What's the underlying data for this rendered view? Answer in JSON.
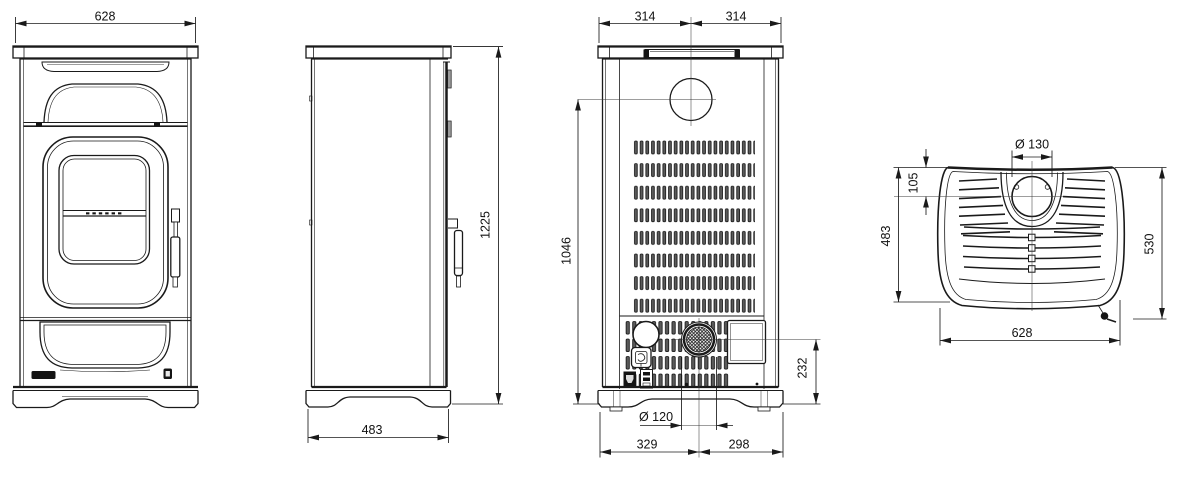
{
  "drawing": {
    "type": "technical-dimension-drawing",
    "subject": "stove",
    "views": [
      "front",
      "side",
      "rear",
      "top"
    ],
    "colors": {
      "line": "#1a1a1a",
      "background": "#ffffff"
    },
    "dimensions": {
      "front_width": "628",
      "side_height": "1225",
      "side_depth": "483",
      "rear_width_left": "314",
      "rear_width_right": "314",
      "rear_flue_center_height": "1046",
      "rear_outlet_center_height": "232",
      "rear_outlet_diameter": "Ø 120",
      "rear_offset_left": "329",
      "rear_offset_right": "298",
      "top_flue_diameter": "Ø 130",
      "top_flue_center_offset": "105",
      "top_body_depth": "483",
      "top_overall_depth": "530",
      "top_width": "628"
    }
  }
}
